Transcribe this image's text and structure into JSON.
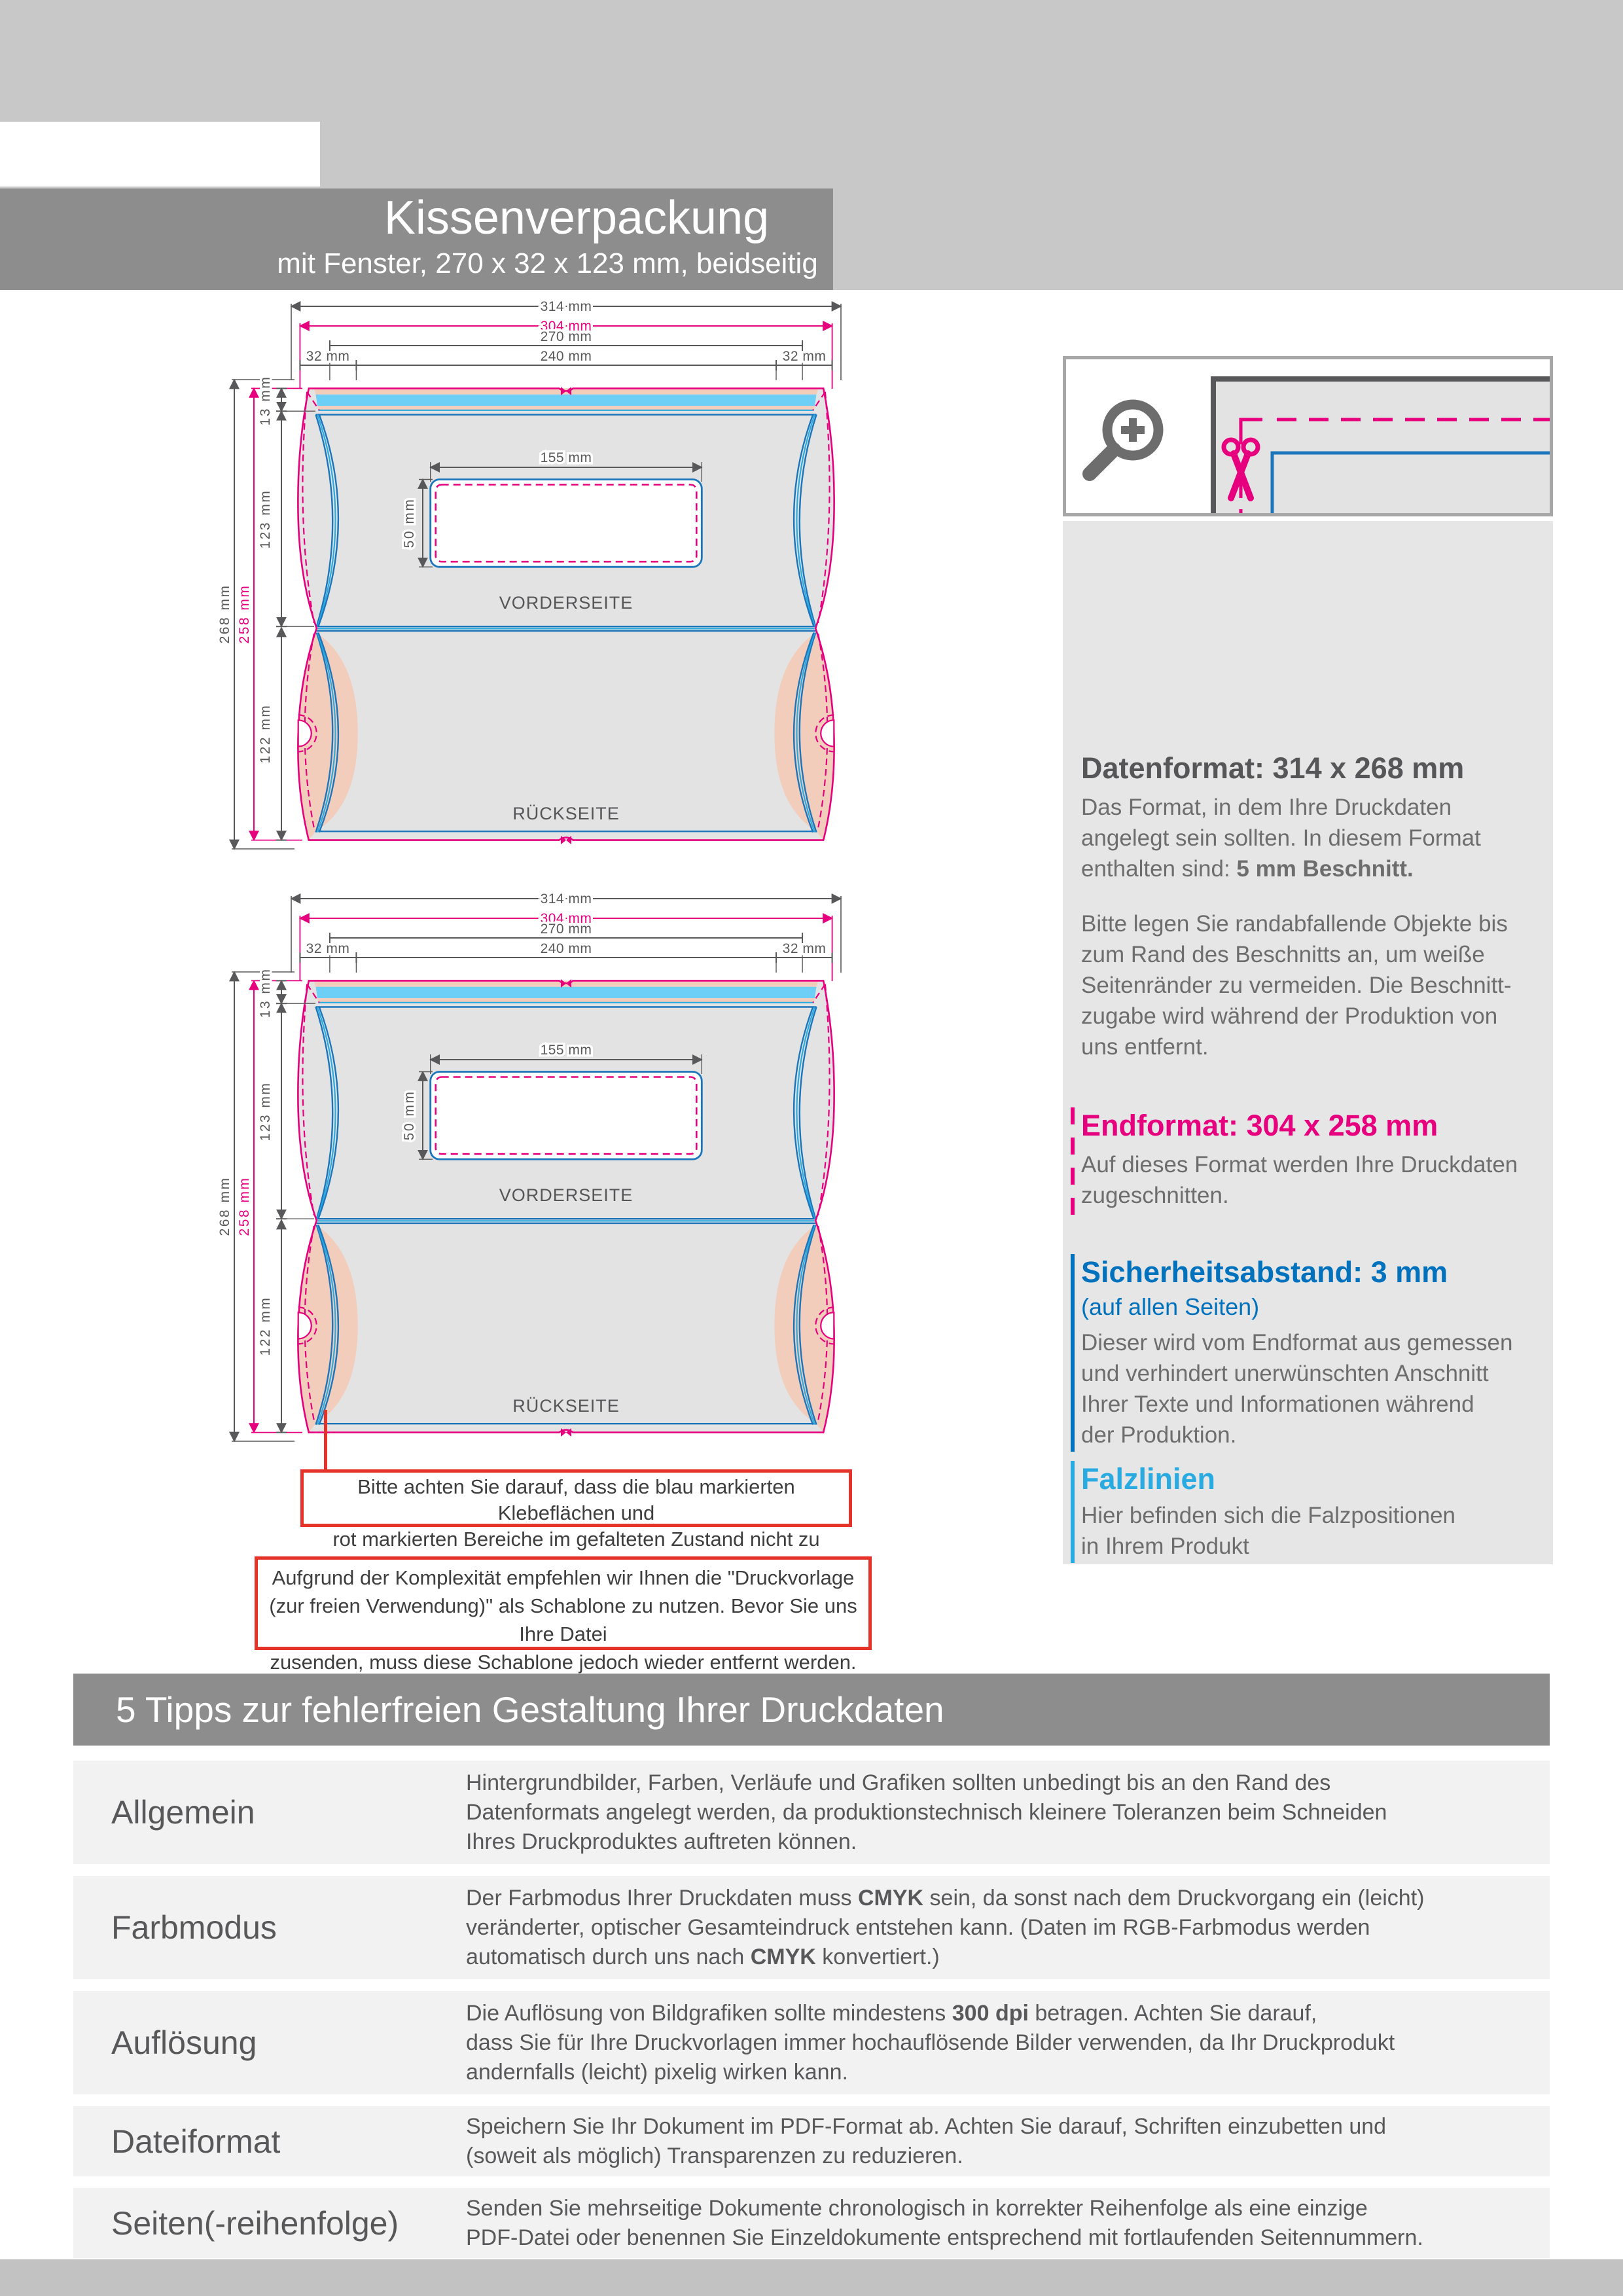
{
  "page": {
    "doc_label": "Datenblatt",
    "header": {
      "title": "Kissenverpackung",
      "subtitle": "mit Fenster, 270 x 32 x 123 mm, beidseitig"
    }
  },
  "colors": {
    "magenta": "#e6007e",
    "blue": "#1b75bb",
    "cyan": "#29abe2",
    "sky_fill": "#6dcff6",
    "peach_fill": "#f2cdbc",
    "shape_gray": "#e3e3e3",
    "dim_gray": "#58585a",
    "warn_red": "#e63329",
    "band_gray": "#8d8d8d"
  },
  "diagram": {
    "width_total": "314 mm",
    "width_end": "304 mm",
    "width_inner": "270 mm",
    "seg_left": "32 mm",
    "seg_mid": "240 mm",
    "seg_right": "32 mm",
    "height_total": "268 mm",
    "height_end": "258 mm",
    "glue_height": "13 mm",
    "front_height": "123 mm",
    "back_height": "122 mm",
    "window_width": "155 mm",
    "window_height": "50 mm",
    "front_label": "VORDERSEITE",
    "back_label": "RÜCKSEITE"
  },
  "info_panel": {
    "datenformat": {
      "heading": "Datenformat: 314 x 268 mm",
      "body1_lines": [
        [
          {
            "t": "Das Format, in dem Ihre Druckdaten"
          }
        ],
        [
          {
            "t": "angelegt sein sollten. In diesem Format"
          }
        ],
        [
          {
            "t": "enthalten sind: "
          },
          {
            "t": "5 mm Beschnitt.",
            "b": true
          }
        ]
      ],
      "body2_lines": [
        [
          {
            "t": "Bitte legen Sie randabfallende Objekte bis"
          }
        ],
        [
          {
            "t": "zum Rand des Beschnitts an, um weiße"
          }
        ],
        [
          {
            "t": "Seitenränder zu vermeiden. Die Beschnitt-"
          }
        ],
        [
          {
            "t": "zugabe wird während der Produktion von"
          }
        ],
        [
          {
            "t": "uns entfernt."
          }
        ]
      ]
    },
    "endformat": {
      "heading": "Endformat: 304 x 258 mm",
      "body_lines": [
        [
          {
            "t": "Auf dieses Format werden Ihre Druckdaten"
          }
        ],
        [
          {
            "t": "zugeschnitten."
          }
        ]
      ]
    },
    "sicherheitsabstand": {
      "heading": "Sicherheitsabstand: 3 mm",
      "subheading": "(auf allen Seiten)",
      "body_lines": [
        [
          {
            "t": "Dieser wird vom Endformat aus gemessen"
          }
        ],
        [
          {
            "t": "und verhindert unerwünschten Anschnitt"
          }
        ],
        [
          {
            "t": "Ihrer Texte und Informationen während"
          }
        ],
        [
          {
            "t": "der Produktion."
          }
        ]
      ]
    },
    "falzlinien": {
      "heading": "Falzlinien",
      "body_lines": [
        [
          {
            "t": "Hier befinden sich die Falzpositionen"
          }
        ],
        [
          {
            "t": "in Ihrem Produkt"
          }
        ]
      ]
    }
  },
  "warnings": [
    {
      "lines": [
        [
          {
            "t": "Bitte achten Sie darauf, dass die blau markierten Klebeflächen und"
          }
        ],
        [
          {
            "t": "rot markierten Bereiche im gefalteten Zustand nicht zu sehen sind."
          }
        ]
      ]
    },
    {
      "lines": [
        [
          {
            "t": "Aufgrund der Komplexität empfehlen wir Ihnen die \"Druckvorlage"
          }
        ],
        [
          {
            "t": "(zur freien Verwendung)\" als Schablone zu nutzen. Bevor Sie uns Ihre Datei"
          }
        ],
        [
          {
            "t": "zusenden, muss diese Schablone jedoch wieder entfernt werden."
          }
        ]
      ]
    }
  ],
  "tips": {
    "heading": "5 Tipps zur fehlerfreien Gestaltung Ihrer Druckdaten",
    "rows": [
      {
        "label": "Allgemein",
        "lines": [
          [
            {
              "t": "Hintergrundbilder, Farben, Verläufe und Grafiken sollten unbedingt bis an den Rand des"
            }
          ],
          [
            {
              "t": "Datenformats angelegt werden, da produktionstechnisch kleinere Toleranzen beim Schneiden"
            }
          ],
          [
            {
              "t": "Ihres Druckproduktes auftreten können."
            }
          ]
        ]
      },
      {
        "label": "Farbmodus",
        "lines": [
          [
            {
              "t": "Der Farbmodus Ihrer Druckdaten muss "
            },
            {
              "t": "CMYK",
              "b": true
            },
            {
              "t": " sein, da sonst nach dem Druckvorgang ein (leicht)"
            }
          ],
          [
            {
              "t": "veränderter, optischer Gesamteindruck entstehen kann. (Daten im RGB-Farbmodus werden"
            }
          ],
          [
            {
              "t": "automatisch durch uns nach "
            },
            {
              "t": "CMYK",
              "b": true
            },
            {
              "t": " konvertiert.)"
            }
          ]
        ]
      },
      {
        "label": "Auflösung",
        "lines": [
          [
            {
              "t": "Die Auflösung von Bildgrafiken sollte mindestens "
            },
            {
              "t": "300 dpi",
              "b": true
            },
            {
              "t": " betragen. Achten Sie darauf,"
            }
          ],
          [
            {
              "t": "dass Sie für Ihre Druckvorlagen immer hochauflösende Bilder verwenden, da Ihr Druckprodukt"
            }
          ],
          [
            {
              "t": "andernfalls (leicht) pixelig wirken kann."
            }
          ]
        ]
      },
      {
        "label": "Dateiformat",
        "lines": [
          [
            {
              "t": "Speichern Sie Ihr Dokument im PDF-Format ab. Achten Sie darauf, Schriften einzubetten und"
            }
          ],
          [
            {
              "t": "(soweit als möglich) Transparenzen zu reduzieren."
            }
          ]
        ]
      },
      {
        "label": "Seiten(-reihenfolge)",
        "lines": [
          [
            {
              "t": "Senden Sie mehrseitige Dokumente chronologisch in korrekter Reihenfolge als eine einzige"
            }
          ],
          [
            {
              "t": "PDF-Datei oder benennen Sie Einzeldokumente entsprechend mit fortlaufenden Seitennummern."
            }
          ]
        ]
      }
    ]
  }
}
